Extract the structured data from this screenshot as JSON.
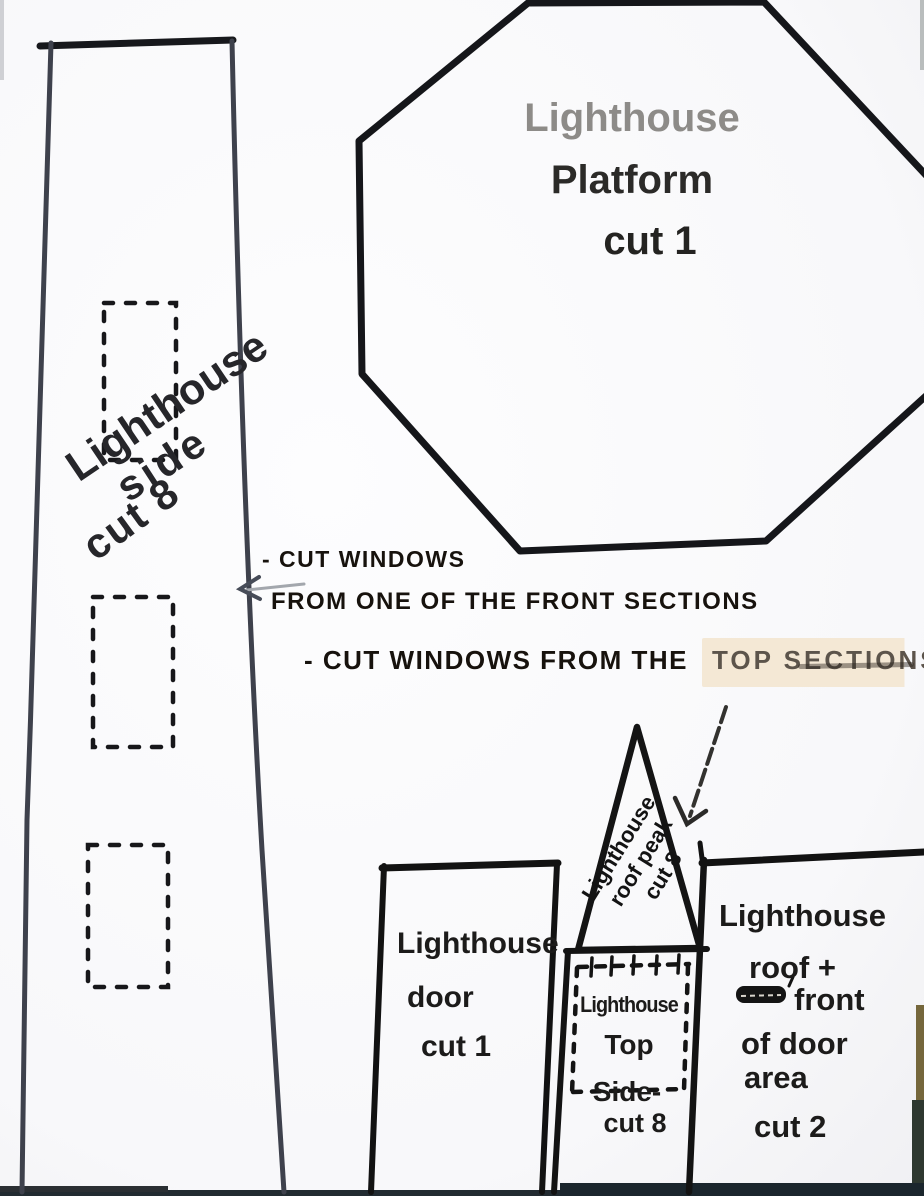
{
  "labels": {
    "platform": [
      "Lighthouse",
      "Platform",
      "cut 1"
    ],
    "side": [
      "Lighthouse",
      "side",
      "cut 8"
    ],
    "door": [
      "Lighthouse",
      "door",
      "cut 1"
    ],
    "roof_peak": [
      "Lighthouse",
      "roof peak",
      "cut 8"
    ],
    "top_side": [
      "Lighthouse",
      "Top",
      "Side-",
      "cut 8"
    ],
    "roof_front": [
      "Lighthouse",
      "roof +",
      "front",
      "of door",
      "area",
      "cut 2"
    ]
  },
  "notes": {
    "note1_line1": "- CUT WINDOWS",
    "note1_line2": "FROM ONE OF THE FRONT SECTIONS",
    "note2_prefix": "- CUT WINDOWS FROM THE",
    "note2_highlight": "TOP SECTIONS"
  },
  "icons": {
    "left_arrow": "arrow-left",
    "down_arrow": "arrow-down-left",
    "scribble": "crossed-out-word"
  },
  "colors": {
    "ink": "#1a1a1a",
    "pencil_stroke": "#3e414c",
    "platform_title_ink": "#8d8b88",
    "note_ink": "#17120d",
    "highlight": "#f4e8d5",
    "highlight_ink": "#5c544b",
    "paper": "#fbfbfc",
    "photo_edge_dark": "#1b262d",
    "photo_edge_olive": "#75673c"
  }
}
